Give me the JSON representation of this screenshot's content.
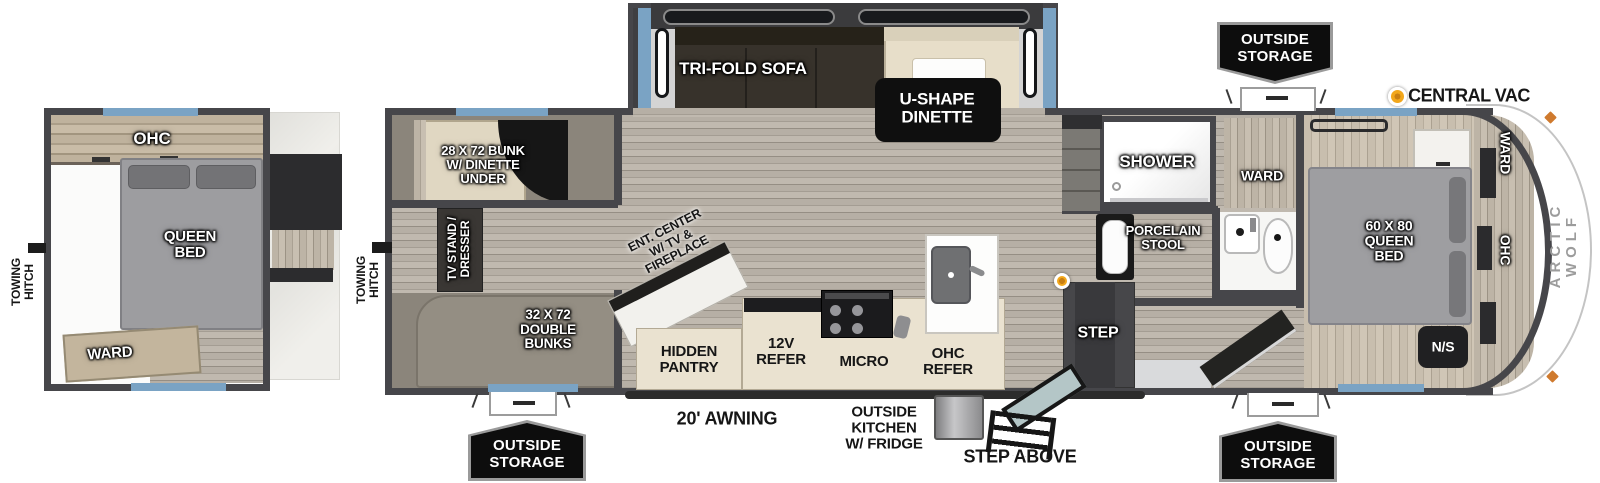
{
  "front_unit": {
    "towing_hitch_label": "TOWING\nHITCH",
    "ohc_label": "OHC",
    "queen_bed_label": "QUEEN\nBED",
    "ward_label": "WARD"
  },
  "main_unit": {
    "towing_hitch_label": "TOWING\nHITCH",
    "brand_label": "ARCTIC WOLF",
    "bunk_room": {
      "bunk_dinette_label": "28 X 72 BUNK\nW/ DINETTE\nUNDER",
      "tv_stand_label": "TV STAND /\nDRESSER",
      "double_bunks_label": "32 X 72\nDOUBLE\nBUNKS"
    },
    "living_area": {
      "tri_fold_sofa_label": "TRI-FOLD SOFA",
      "u_shape_dinette_label": "U-SHAPE\nDINETTE",
      "ent_center_label": "ENT. CENTER\nW/ TV &\nFIREPLACE",
      "hidden_pantry_label": "HIDDEN\nPANTRY"
    },
    "kitchen": {
      "refer_12v_label": "12V\nREFER",
      "micro_label": "MICRO",
      "ohc_refer_label": "OHC\nREFER"
    },
    "bathroom": {
      "shower_label": "SHOWER",
      "porcelain_stool_label": "PORCELAIN\nSTOOL",
      "ward_label": "WARD"
    },
    "bedroom": {
      "queen_bed_label": "60 X 80\nQUEEN\nBED",
      "ward_label": "WARD",
      "ohc_label": "OHC",
      "nightstand_label": "N/S"
    },
    "entry": {
      "step_label": "STEP"
    }
  },
  "exterior": {
    "outside_storage_label": "OUTSIDE\nSTORAGE",
    "central_vac_label": "CENTRAL VAC",
    "awning_label": "20' AWNING",
    "outside_kitchen_label": "OUTSIDE\nKITCHEN\nW/ FRIDGE",
    "step_above_label": "STEP ABOVE"
  },
  "colors": {
    "wall": "#46464a",
    "window_blue": "#7aa3c4",
    "accent_yellow": "#f2a71b",
    "badge_black": "#0d0d0d"
  }
}
